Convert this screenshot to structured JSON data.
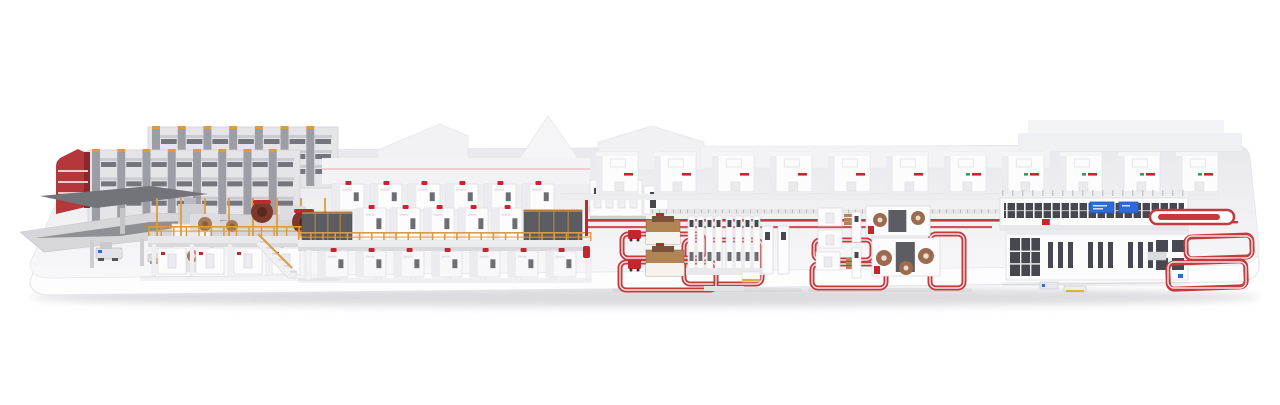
{
  "meta": {
    "description": "3D rendering of a complete corrugated board production line on a white rounded display platform: high-bay roll storage and AGV reel handling on the left, corrugator wet end with paper rolls and orange railings, long elevated double-facer drying section, dry-end cabinets, converting cells connected by red loop conveyors, rotary converting machines with brown rolls, and a sorting/palletizing logistics line with empty red shipping loops on the right"
  },
  "visible_text": [],
  "palette": {
    "background": "#ffffff",
    "platform_top": "#ebebee",
    "platform_top_light": "#f8f8fa",
    "platform_face": "#fdfdfe",
    "platform_edge": "#e3e3e8",
    "ground_shadow": "#b9b9c0",
    "machine_white": "#fcfcfd",
    "machine_light": "#ececf0",
    "machine_mid": "#d9d9de",
    "structure_gray": "#9d9da5",
    "deck_gray": "#d7d7db",
    "ramp_dark": "#73737a",
    "panel_dark": "#5c5c63",
    "window_dark": "#46474f",
    "slot_gray": "#6d6d74",
    "accent_red": "#c1272d",
    "conveyor_red": "#c43a3f",
    "loop_inner": "#f6e2e2",
    "rail_orange": "#df9a3f",
    "paper_brown": "#a87a58",
    "paper_dark": "#7e382b",
    "cardboard": "#b08455",
    "screen_blue": "#2e6bd8",
    "label_green": "#3a9a5c",
    "pallet_yellow": "#d9b23a"
  },
  "scene": {
    "sections": [
      {
        "id": "roll-storage",
        "label": "high-bay paper roll storage racks"
      },
      {
        "id": "reel-handling",
        "label": "reel handling deck with AGV shuttles"
      },
      {
        "id": "wet-end",
        "label": "corrugator wet end with splicers and paper rolls"
      },
      {
        "id": "corrugator",
        "label": "elevated double facer drying section"
      },
      {
        "id": "dry-end",
        "label": "dry end cutoff and stacker cabinets"
      },
      {
        "id": "converting-cell-1",
        "label": "converting cell with stacker towers and loop conveyors"
      },
      {
        "id": "converting-cell-2",
        "label": "rotary converting machines with brown rolls"
      },
      {
        "id": "logistics-sorter",
        "label": "sorting line with blue display screens"
      },
      {
        "id": "shipping-loops",
        "label": "empty red shipping conveyor loops"
      }
    ],
    "counts": {
      "rack_columns_back": 7,
      "rack_columns_front": 8,
      "corrugator_modules_top": 6,
      "corrugator_modules_mid": 5,
      "corrugator_modules_ground": 7,
      "corrugator_legs": 9,
      "background_cubes": 11,
      "tower_cluster_size": 4,
      "sorter_mullions": 20,
      "hall_door_slots": 12,
      "railing_posts_wetend": 15,
      "railing_posts_corrugator": 24
    }
  }
}
